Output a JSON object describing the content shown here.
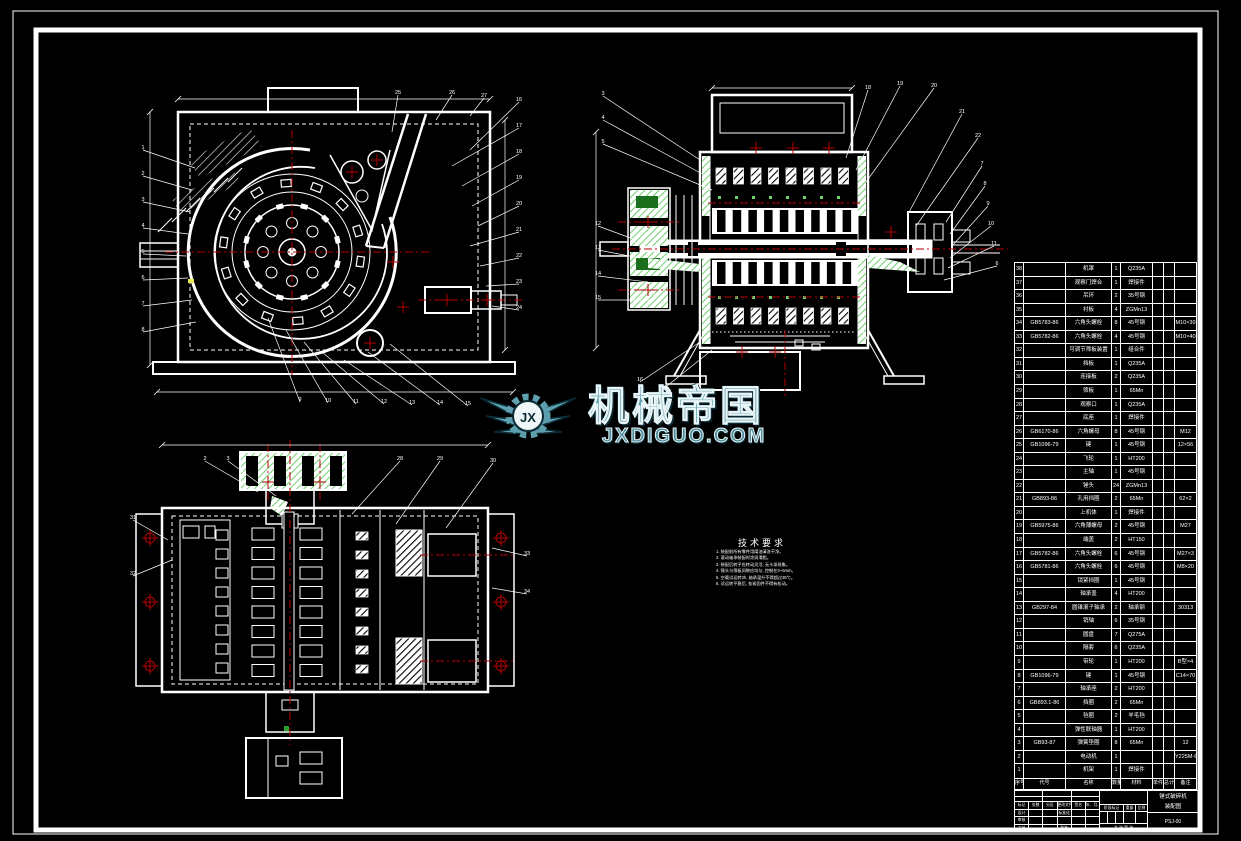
{
  "watermark": {
    "brand": "机械帝国",
    "domain": "JXDIGUO.COM",
    "logo_text": "JX",
    "color": "#5d9fae"
  },
  "tech_requirements": {
    "title": "技术要求",
    "lines": [
      "1. 装配前所有零件用煤油清洗干净。",
      "2. 滚动轴承装配时涂润滑脂。",
      "3. 装配后转子应转动灵活, 无卡滞现象。",
      "4. 锤头与筛板间隙应均匀,  控制在3~5mm。",
      "5. 空载试运转2h, 轴承温升不得超过35℃。",
      "6. 试运转平稳后, 各紧固件不得有松动。"
    ]
  },
  "parts_table": {
    "headers": {
      "no": "序号",
      "code": "代号",
      "name": "名称",
      "qty": "数量",
      "material": "材料",
      "unit": "单件",
      "total": "总计",
      "remark": "备注"
    },
    "rows": [
      {
        "no": "38",
        "code": "",
        "name": "机罩",
        "qty": "1",
        "mat": "Q235A",
        "remark": ""
      },
      {
        "no": "37",
        "code": "",
        "name": "观察门焊合",
        "qty": "1",
        "mat": "焊接件",
        "remark": ""
      },
      {
        "no": "36",
        "code": "",
        "name": "吊环",
        "qty": "2",
        "mat": "35号钢",
        "remark": ""
      },
      {
        "no": "35",
        "code": "",
        "name": "衬板",
        "qty": "4",
        "mat": "ZGMn13",
        "remark": ""
      },
      {
        "no": "34",
        "code": "GB5783-86",
        "name": "六角头螺栓",
        "qty": "8",
        "mat": "45号钢",
        "remark": "M10×30"
      },
      {
        "no": "33",
        "code": "GB5782-86",
        "name": "六角头螺栓",
        "qty": "4",
        "mat": "45号钢",
        "remark": "M10×40"
      },
      {
        "no": "32",
        "code": "",
        "name": "可调节筛板装置",
        "qty": "1",
        "mat": "组合件",
        "remark": ""
      },
      {
        "no": "31",
        "code": "",
        "name": "挡板",
        "qty": "1",
        "mat": "Q235A",
        "remark": ""
      },
      {
        "no": "30",
        "code": "",
        "name": "连接板",
        "qty": "2",
        "mat": "Q235A",
        "remark": ""
      },
      {
        "no": "29",
        "code": "",
        "name": "筛板",
        "qty": "1",
        "mat": "65Mn",
        "remark": ""
      },
      {
        "no": "28",
        "code": "",
        "name": "观察口",
        "qty": "1",
        "mat": "Q235A",
        "remark": ""
      },
      {
        "no": "27",
        "code": "",
        "name": "底座",
        "qty": "1",
        "mat": "焊接件",
        "remark": ""
      },
      {
        "no": "26",
        "code": "GB6170-86",
        "name": "六角螺母",
        "qty": "8",
        "mat": "45号钢",
        "remark": "M12"
      },
      {
        "no": "25",
        "code": "GB1096-79",
        "name": "键",
        "qty": "1",
        "mat": "45号钢",
        "remark": "12×56"
      },
      {
        "no": "24",
        "code": "",
        "name": "飞轮",
        "qty": "1",
        "mat": "HT200",
        "remark": ""
      },
      {
        "no": "23",
        "code": "",
        "name": "主轴",
        "qty": "1",
        "mat": "45号钢",
        "remark": ""
      },
      {
        "no": "22",
        "code": "",
        "name": "锤头",
        "qty": "24",
        "mat": "ZGMn13",
        "remark": ""
      },
      {
        "no": "21",
        "code": "GB893-86",
        "name": "孔用挡圈",
        "qty": "2",
        "mat": "65Mn",
        "remark": "62×2"
      },
      {
        "no": "20",
        "code": "",
        "name": "上机体",
        "qty": "1",
        "mat": "焊接件",
        "remark": ""
      },
      {
        "no": "19",
        "code": "GB5975-86",
        "name": "六角薄螺母",
        "qty": "2",
        "mat": "45号钢",
        "remark": "M27"
      },
      {
        "no": "18",
        "code": "",
        "name": "端盖",
        "qty": "2",
        "mat": "HT150",
        "remark": ""
      },
      {
        "no": "17",
        "code": "GB5782-86",
        "name": "六角头螺栓",
        "qty": "6",
        "mat": "45号钢",
        "remark": "M27×3"
      },
      {
        "no": "16",
        "code": "GB5781-86",
        "name": "六角头螺栓",
        "qty": "6",
        "mat": "45号钢",
        "remark": "M8×20"
      },
      {
        "no": "15",
        "code": "",
        "name": "锁紧挡圈",
        "qty": "1",
        "mat": "45号钢",
        "remark": ""
      },
      {
        "no": "14",
        "code": "",
        "name": "轴承盖",
        "qty": "4",
        "mat": "HT200",
        "remark": ""
      },
      {
        "no": "13",
        "code": "GB297-84",
        "name": "圆锥滚子轴承",
        "qty": "2",
        "mat": "轴承钢",
        "remark": "30313"
      },
      {
        "no": "12",
        "code": "",
        "name": "销轴",
        "qty": "6",
        "mat": "35号钢",
        "remark": ""
      },
      {
        "no": "11",
        "code": "",
        "name": "圆盘",
        "qty": "7",
        "mat": "Q275A",
        "remark": ""
      },
      {
        "no": "10",
        "code": "",
        "name": "隔套",
        "qty": "6",
        "mat": "Q235A",
        "remark": ""
      },
      {
        "no": "9",
        "code": "",
        "name": "带轮",
        "qty": "1",
        "mat": "HT200",
        "remark": "B型×4"
      },
      {
        "no": "8",
        "code": "GB1096-79",
        "name": "键",
        "qty": "1",
        "mat": "45号钢",
        "remark": "C14×70"
      },
      {
        "no": "7",
        "code": "",
        "name": "轴承座",
        "qty": "2",
        "mat": "HT200",
        "remark": ""
      },
      {
        "no": "6",
        "code": "GB893.1-86",
        "name": "挡圈",
        "qty": "2",
        "mat": "65Mn",
        "remark": ""
      },
      {
        "no": "5",
        "code": "",
        "name": "毡圈",
        "qty": "2",
        "mat": "羊毛毡",
        "remark": ""
      },
      {
        "no": "4",
        "code": "",
        "name": "弹性联轴器",
        "qty": "1",
        "mat": "HT200",
        "remark": ""
      },
      {
        "no": "3",
        "code": "GB93-87",
        "name": "弹簧垫圈",
        "qty": "8",
        "mat": "65Mn",
        "remark": "12"
      },
      {
        "no": "2",
        "code": "",
        "name": "电动机",
        "qty": "1",
        "mat": "",
        "remark": "Y225M-6"
      },
      {
        "no": "1",
        "code": "",
        "name": "机架",
        "qty": "1",
        "mat": "焊接件",
        "remark": ""
      }
    ]
  },
  "title_block": {
    "rev_labels": [
      "标记",
      "处数",
      "分区",
      "更改文件号",
      "签名",
      "年、月、日"
    ],
    "row_design": [
      "设计",
      "",
      "",
      "标准化",
      "",
      ""
    ],
    "row_check": [
      "审核",
      "",
      "",
      "",
      "",
      ""
    ],
    "row_craft": [
      "工艺",
      "",
      "",
      "批准",
      "",
      ""
    ],
    "stage_label": "阶段标记",
    "weight_label": "重量",
    "scale_label": "比例",
    "sheet_label": "共 张 第 张",
    "title_line1": "锤式破碎机",
    "title_line2": "装配图",
    "code": "PSJ-00"
  },
  "balloons": {
    "view1": [
      {
        "x": 143,
        "y": 150,
        "n": "1"
      },
      {
        "x": 143,
        "y": 176,
        "n": "2"
      },
      {
        "x": 143,
        "y": 202,
        "n": "3"
      },
      {
        "x": 143,
        "y": 228,
        "n": "4"
      },
      {
        "x": 143,
        "y": 254,
        "n": "5"
      },
      {
        "x": 143,
        "y": 280,
        "n": "6"
      },
      {
        "x": 143,
        "y": 306,
        "n": "7"
      },
      {
        "x": 143,
        "y": 332,
        "n": "8"
      },
      {
        "x": 300,
        "y": 402,
        "n": "9"
      },
      {
        "x": 328,
        "y": 403,
        "n": "10"
      },
      {
        "x": 356,
        "y": 404,
        "n": "11"
      },
      {
        "x": 384,
        "y": 404,
        "n": "12"
      },
      {
        "x": 412,
        "y": 405,
        "n": "13"
      },
      {
        "x": 440,
        "y": 405,
        "n": "14"
      },
      {
        "x": 468,
        "y": 406,
        "n": "15"
      },
      {
        "x": 519,
        "y": 102,
        "n": "16"
      },
      {
        "x": 519,
        "y": 128,
        "n": "17"
      },
      {
        "x": 519,
        "y": 154,
        "n": "18"
      },
      {
        "x": 519,
        "y": 180,
        "n": "19"
      },
      {
        "x": 519,
        "y": 206,
        "n": "20"
      },
      {
        "x": 519,
        "y": 232,
        "n": "21"
      },
      {
        "x": 519,
        "y": 258,
        "n": "22"
      },
      {
        "x": 519,
        "y": 284,
        "n": "23"
      },
      {
        "x": 519,
        "y": 310,
        "n": "24"
      },
      {
        "x": 398,
        "y": 95,
        "n": "25"
      },
      {
        "x": 452,
        "y": 95,
        "n": "26"
      },
      {
        "x": 484,
        "y": 98,
        "n": "27"
      }
    ],
    "view2": [
      {
        "x": 603,
        "y": 96,
        "n": "3"
      },
      {
        "x": 603,
        "y": 120,
        "n": "4"
      },
      {
        "x": 603,
        "y": 144,
        "n": "5"
      },
      {
        "x": 598,
        "y": 226,
        "n": "12"
      },
      {
        "x": 598,
        "y": 250,
        "n": "13"
      },
      {
        "x": 598,
        "y": 276,
        "n": "14"
      },
      {
        "x": 598,
        "y": 300,
        "n": "15"
      },
      {
        "x": 640,
        "y": 382,
        "n": "16"
      },
      {
        "x": 662,
        "y": 390,
        "n": "17"
      },
      {
        "x": 868,
        "y": 90,
        "n": "18"
      },
      {
        "x": 900,
        "y": 86,
        "n": "19"
      },
      {
        "x": 934,
        "y": 88,
        "n": "20"
      },
      {
        "x": 962,
        "y": 114,
        "n": "21"
      },
      {
        "x": 978,
        "y": 138,
        "n": "22"
      },
      {
        "x": 982,
        "y": 166,
        "n": "7"
      },
      {
        "x": 985,
        "y": 186,
        "n": "8"
      },
      {
        "x": 988,
        "y": 206,
        "n": "9"
      },
      {
        "x": 991,
        "y": 226,
        "n": "10"
      },
      {
        "x": 994,
        "y": 246,
        "n": "11"
      },
      {
        "x": 997,
        "y": 266,
        "n": "6"
      }
    ],
    "view3": [
      {
        "x": 205,
        "y": 461,
        "n": "2"
      },
      {
        "x": 228,
        "y": 461,
        "n": "3"
      },
      {
        "x": 400,
        "y": 461,
        "n": "28"
      },
      {
        "x": 440,
        "y": 461,
        "n": "29"
      },
      {
        "x": 493,
        "y": 463,
        "n": "30"
      },
      {
        "x": 133,
        "y": 520,
        "n": "31"
      },
      {
        "x": 133,
        "y": 576,
        "n": "32"
      },
      {
        "x": 527,
        "y": 556,
        "n": "33"
      },
      {
        "x": 527,
        "y": 594,
        "n": "34"
      }
    ]
  },
  "colors": {
    "line": "#ffffff",
    "centerline": "#b40000",
    "hatch_green": "#6fd06f",
    "solid_green": "#1b6e1b",
    "accent_yellow": "#e8e84a",
    "watermark": "#5d9fae"
  }
}
